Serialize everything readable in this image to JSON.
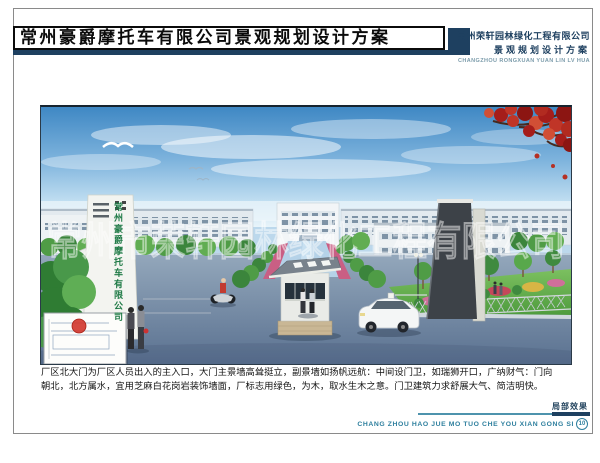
{
  "header": {
    "title": "常州豪爵摩托车有限公司景观规划设计方案",
    "company_name": "常州荣轩园林绿化工程有限公司",
    "company_subtitle": "景观规划设计方案",
    "company_romanized": "CHANGZHOU RONGXUAN YUAN LIN LV HUA"
  },
  "photo": {
    "gate_sign": "常州豪爵摩托车有限公司",
    "watermark": "常州市荣轩园林绿化工程有限公司"
  },
  "description": {
    "line1": "厂区北大门为厂区人员出入的主入口，大门主景墙高耸挺立，副景墙如扬帆远航：中间设门卫，如瑞狮开口，广纳财气：门向",
    "line2": "朝北，北方属水，宜用芝麻白花岗岩装饰墙面，厂标志用绿色，为木，取水生木之意。门卫建筑力求舒展大气、简洁明快。"
  },
  "footer": {
    "label": "局部效果",
    "romanized": "CHANG ZHOU HAO JUE MO TUO CHE YOU XIAN GONG SI",
    "page_number": "10"
  },
  "colors": {
    "navy": "#1e4060",
    "teal": "#2e7f9e",
    "rule_teal": "#4e93ad",
    "sign_green": "#1f7a46",
    "stamp_red": "#d23a30",
    "sky_top": "#3f88c4",
    "maple_red": "#a51d1a"
  }
}
